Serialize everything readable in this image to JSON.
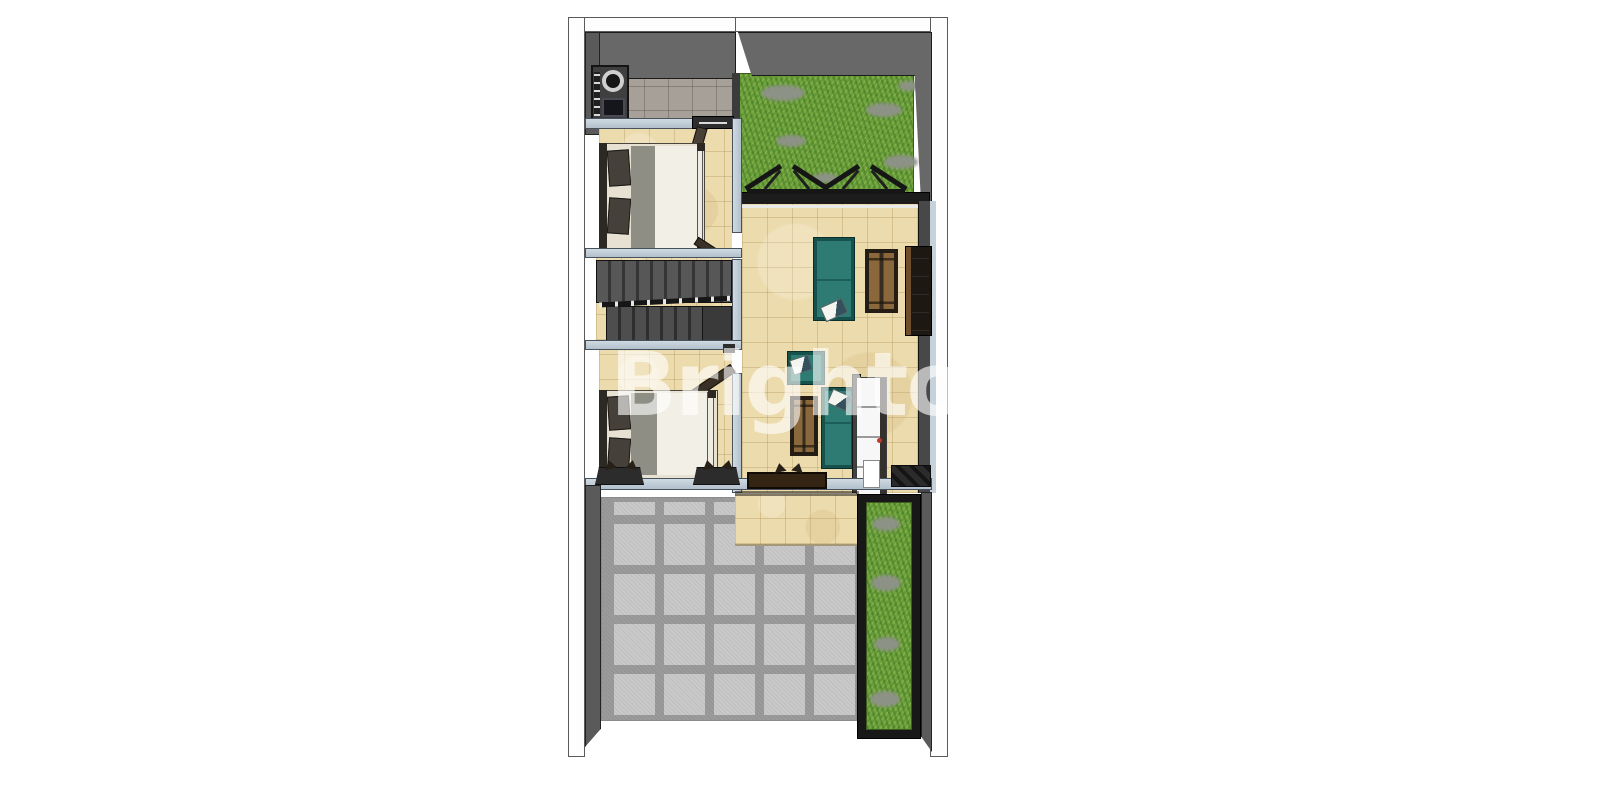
{
  "watermark": {
    "text": "Brighton"
  },
  "palette": {
    "background": "#ffffff",
    "outer_wall_white": "#fdfdfd",
    "wall_dark_gray": "#686868",
    "wall_light_blue": "#c3ced8",
    "floor_beige_tile": "#ecdbad",
    "floor_gray_tile": "#a7a099",
    "paver_gray": "#c9c9c9",
    "grass_green": "#6fa23c",
    "stone_gray": "#8f928a",
    "sofa_teal": "#2d7b72",
    "wood_brown": "#8a683c",
    "stair_gray": "#4a4a4a",
    "bed_duvet_cream": "#f2efe6",
    "bed_blanket_gray": "#8f8e85",
    "cabinet_white": "#f8f8f8",
    "knob_red": "#c0392b",
    "truss_black": "#1c1c1c"
  },
  "rooms": [
    {
      "name": "service-area",
      "features": [
        "stove-unit",
        "gray-tile-floor"
      ]
    },
    {
      "name": "roof-garden",
      "features": [
        "grass",
        "stepping-stones",
        "pergola-trusses"
      ]
    },
    {
      "name": "bedroom-upper",
      "features": [
        "double-bed",
        "swing-door"
      ]
    },
    {
      "name": "stair-hall",
      "features": [
        "u-shaped-staircase",
        "handrail"
      ]
    },
    {
      "name": "bedroom-lower",
      "features": [
        "double-bed",
        "swing-door"
      ]
    },
    {
      "name": "living-room",
      "features": [
        "teal-sofa",
        "teal-armchair",
        "wood-bench",
        "wood-coffee-table",
        "tv-console",
        "tall-white-cabinet"
      ]
    },
    {
      "name": "terrace-step",
      "features": [
        "beige-tiles"
      ]
    },
    {
      "name": "carport",
      "features": [
        "concrete-pavers"
      ]
    },
    {
      "name": "side-planter",
      "features": [
        "grass-strip",
        "stepping-stones"
      ]
    }
  ]
}
